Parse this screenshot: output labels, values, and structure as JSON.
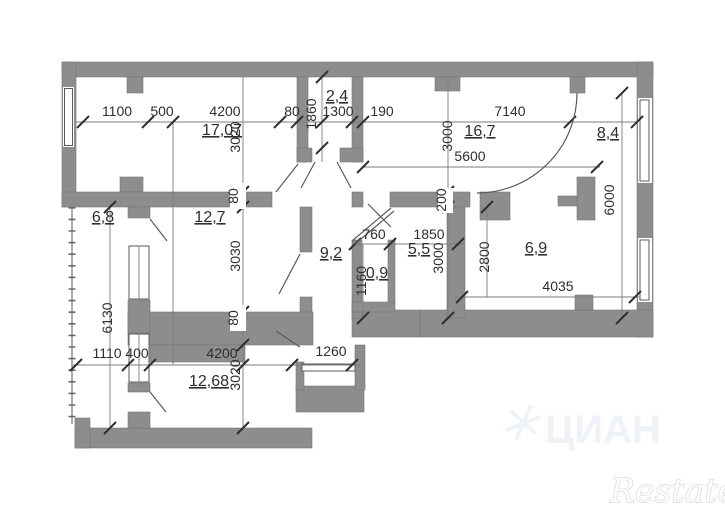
{
  "plan": {
    "type": "apartment-floor-plan",
    "colors": {
      "wall": "#8d8d8d",
      "line": "#7d7d7d",
      "text": "#2e2e2e",
      "tick": "#2f2f2f",
      "watermark_cian": "#eff2f6",
      "watermark_restate": "#c8c8c8"
    },
    "rooms": {
      "living": {
        "label": "17,07"
      },
      "wardrobe": {
        "label": "2,4"
      },
      "kitchen_living": {
        "label": "16,7"
      },
      "corridor_right": {
        "label": "8,4"
      },
      "balcony": {
        "label": "6,8"
      },
      "bedroom": {
        "label": "12,7"
      },
      "hallway": {
        "label": "9,2"
      },
      "bathroom": {
        "label": "5,5"
      },
      "wc": {
        "label": "0,9"
      },
      "kitchen": {
        "label": "6,9"
      },
      "bedroom2": {
        "label": "12,68"
      }
    },
    "dimensions": {
      "top_1100": "1100",
      "top_500": "500",
      "top_4200": "4200",
      "top_80": "80",
      "top_1300": "1300",
      "top_190": "190",
      "top_7140": "7140",
      "mid_5600": "5600",
      "left_3020": "3020",
      "left_80a": "80",
      "left_3030": "3030",
      "left_80b": "80",
      "left_3020b": "3020",
      "left_6130": "6130",
      "v_1860": "1860",
      "v_3000a": "3000",
      "v_6000": "6000",
      "v_200": "200",
      "v_1160": "1160",
      "v_3000b": "3000",
      "v_2800": "2800",
      "mid_760": "760",
      "mid_1850": "1850",
      "mid_4035": "4035",
      "bot_1110": "1110",
      "bot_400": "400",
      "bot_4200": "4200",
      "bot_1260": "1260"
    }
  },
  "watermarks": {
    "cian": "ЦИАН",
    "restate": "Restate"
  }
}
